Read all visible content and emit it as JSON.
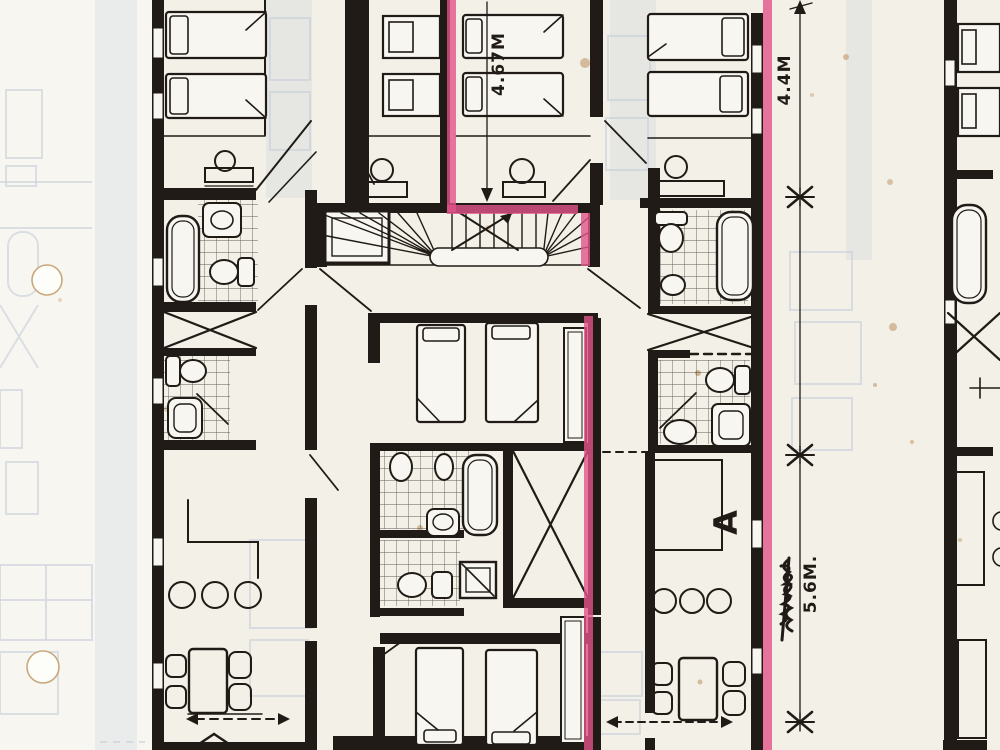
{
  "page": {
    "annotations": {
      "dim_center_vertical": "4.67M",
      "dim_right_top": "4.4M",
      "dim_right_bottom": "5.6M.",
      "room_label": "A"
    },
    "colors": {
      "paper": "#f3f0e7",
      "paper_light": "#f8f6f1",
      "ink": "#201b16",
      "highlight": "#e25489",
      "ghost": "#c6cfdb",
      "stain": "#b5854f"
    }
  }
}
